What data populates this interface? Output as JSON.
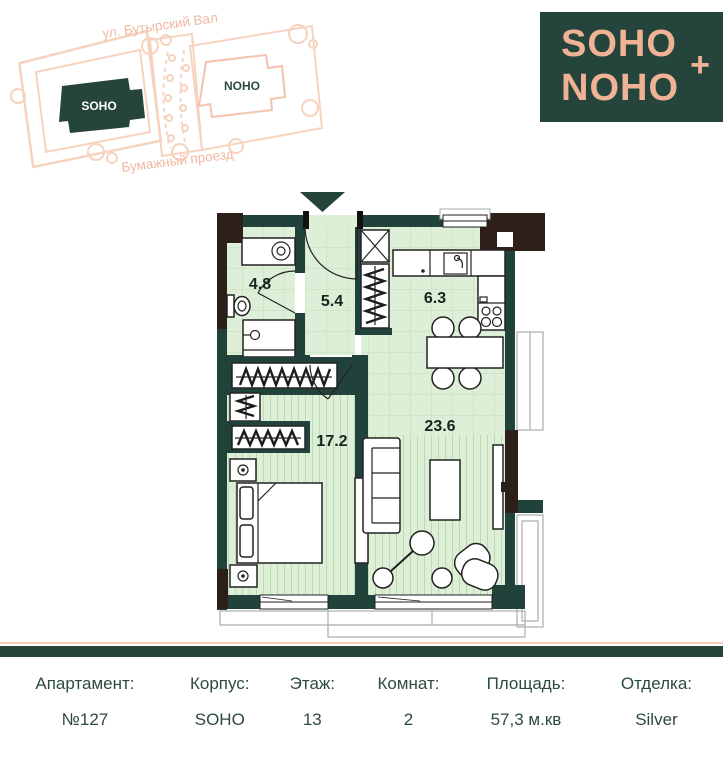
{
  "site_map": {
    "street_top": "ул. Бутырский Вал",
    "street_bottom": "Бумажный проезд",
    "building_soho": "SOHO",
    "building_noho": "NOHO"
  },
  "logo": {
    "line1": "SOHO",
    "line2": "NOHO",
    "plus": "+"
  },
  "floor_plan": {
    "rooms": [
      {
        "name": "bathroom",
        "area": "4.8"
      },
      {
        "name": "hallway",
        "area": "5.4"
      },
      {
        "name": "kitchen",
        "area": "6.3"
      },
      {
        "name": "bedroom",
        "area": "17.2"
      },
      {
        "name": "living-room",
        "area": "23.6"
      }
    ]
  },
  "info_table": {
    "columns": [
      {
        "label": "Апартамент:",
        "value": "№127"
      },
      {
        "label": "Корпус:",
        "value": "SOHO"
      },
      {
        "label": "Этаж:",
        "value": "13"
      },
      {
        "label": "Комнат:",
        "value": "2"
      },
      {
        "label": "Площадь:",
        "value": "57,3 м.кв"
      },
      {
        "label": "Отделка:",
        "value": "Silver"
      }
    ]
  },
  "colors": {
    "brand_teal": "#24443c",
    "brand_peach": "#efb295",
    "wall": "#21423a",
    "wall_corner_brown": "#2f1f19",
    "floor_green": "#ddefd7",
    "text": "#2c4a42"
  }
}
